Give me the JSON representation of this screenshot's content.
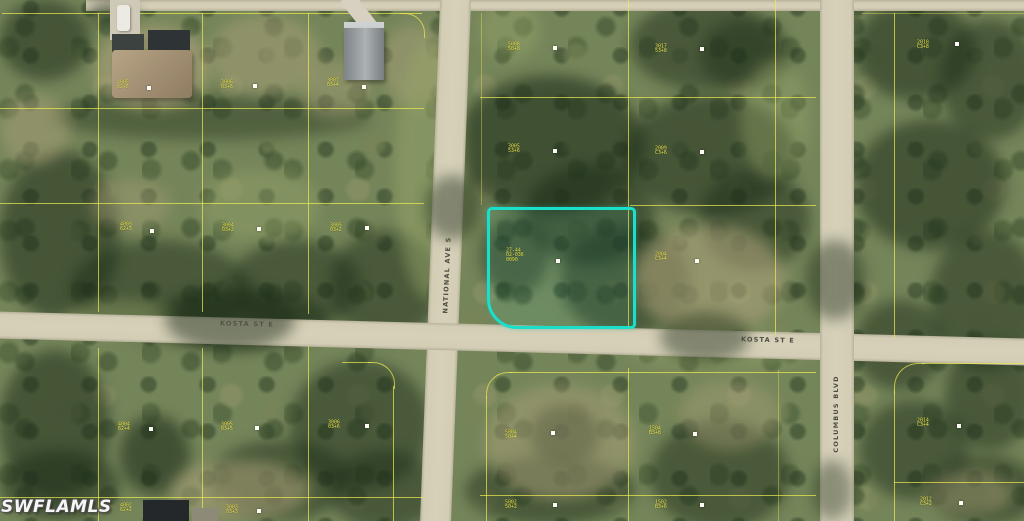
{
  "map": {
    "watermark": "SWFLAMLS",
    "streets": {
      "national": "NATIONAL AVE S",
      "kosta_west": "KOSTA ST E",
      "kosta_east": "KOSTA ST E",
      "columbus": "COLUMBUS BLVD"
    },
    "colors": {
      "highlight": "#1adfcb",
      "parcel_line": "#f0ec50",
      "label_text": "#ede84f",
      "road": "#d3cdb5"
    },
    "highlighted_parcel": {
      "label_lines": [
        "27-44",
        "02-036",
        "0090"
      ]
    },
    "parcel_labels": [
      {
        "x": 117,
        "y": 80,
        "lines": [
          "4005",
          "62+5"
        ]
      },
      {
        "x": 221,
        "y": 80,
        "lines": [
          "3006",
          "03+6"
        ]
      },
      {
        "x": 327,
        "y": 78,
        "lines": [
          "3007",
          "03+4"
        ]
      },
      {
        "x": 508,
        "y": 42,
        "lines": [
          "5008",
          "50+8"
        ]
      },
      {
        "x": 655,
        "y": 44,
        "lines": [
          "3017",
          "53+8"
        ]
      },
      {
        "x": 917,
        "y": 40,
        "lines": [
          "2018",
          "C3+8"
        ]
      },
      {
        "x": 508,
        "y": 144,
        "lines": [
          "3005",
          "53+6"
        ]
      },
      {
        "x": 655,
        "y": 146,
        "lines": [
          "2009",
          "C3+6"
        ]
      },
      {
        "x": 120,
        "y": 222,
        "lines": [
          "4003",
          "62+3"
        ]
      },
      {
        "x": 222,
        "y": 223,
        "lines": [
          "3004",
          "03+2"
        ]
      },
      {
        "x": 330,
        "y": 223,
        "lines": [
          "3005",
          "03+2"
        ]
      },
      {
        "x": 506,
        "y": 248,
        "lines": [
          "27-44",
          "02-036",
          "0090"
        ]
      },
      {
        "x": 655,
        "y": 252,
        "lines": [
          "2004",
          "C3+4"
        ]
      },
      {
        "x": 118,
        "y": 422,
        "lines": [
          "4004",
          "62+4"
        ]
      },
      {
        "x": 221,
        "y": 422,
        "lines": [
          "3005",
          "03+5"
        ]
      },
      {
        "x": 328,
        "y": 420,
        "lines": [
          "3006",
          "03+6"
        ]
      },
      {
        "x": 505,
        "y": 430,
        "lines": [
          "5004",
          "50+4"
        ]
      },
      {
        "x": 649,
        "y": 426,
        "lines": [
          "1504",
          "B3+8"
        ]
      },
      {
        "x": 917,
        "y": 418,
        "lines": [
          "2014",
          "C3+4"
        ]
      },
      {
        "x": 120,
        "y": 503,
        "lines": [
          "4002",
          "62+2"
        ]
      },
      {
        "x": 226,
        "y": 505,
        "lines": [
          "3003",
          "03+3"
        ]
      },
      {
        "x": 505,
        "y": 500,
        "lines": [
          "5002",
          "50+2"
        ]
      },
      {
        "x": 655,
        "y": 500,
        "lines": [
          "1502",
          "B3+6"
        ]
      },
      {
        "x": 920,
        "y": 497,
        "lines": [
          "2012",
          "C3+2"
        ]
      }
    ],
    "markers": [
      {
        "x": 553,
        "y": 46
      },
      {
        "x": 700,
        "y": 47
      },
      {
        "x": 955,
        "y": 42
      },
      {
        "x": 147,
        "y": 86
      },
      {
        "x": 253,
        "y": 84
      },
      {
        "x": 362,
        "y": 85
      },
      {
        "x": 553,
        "y": 149
      },
      {
        "x": 700,
        "y": 150
      },
      {
        "x": 150,
        "y": 229
      },
      {
        "x": 257,
        "y": 227
      },
      {
        "x": 365,
        "y": 226
      },
      {
        "x": 556,
        "y": 259
      },
      {
        "x": 695,
        "y": 259
      },
      {
        "x": 149,
        "y": 427
      },
      {
        "x": 255,
        "y": 426
      },
      {
        "x": 365,
        "y": 424
      },
      {
        "x": 551,
        "y": 431
      },
      {
        "x": 693,
        "y": 432
      },
      {
        "x": 957,
        "y": 424
      },
      {
        "x": 257,
        "y": 509
      },
      {
        "x": 553,
        "y": 503
      },
      {
        "x": 700,
        "y": 503
      },
      {
        "x": 959,
        "y": 501
      }
    ]
  }
}
